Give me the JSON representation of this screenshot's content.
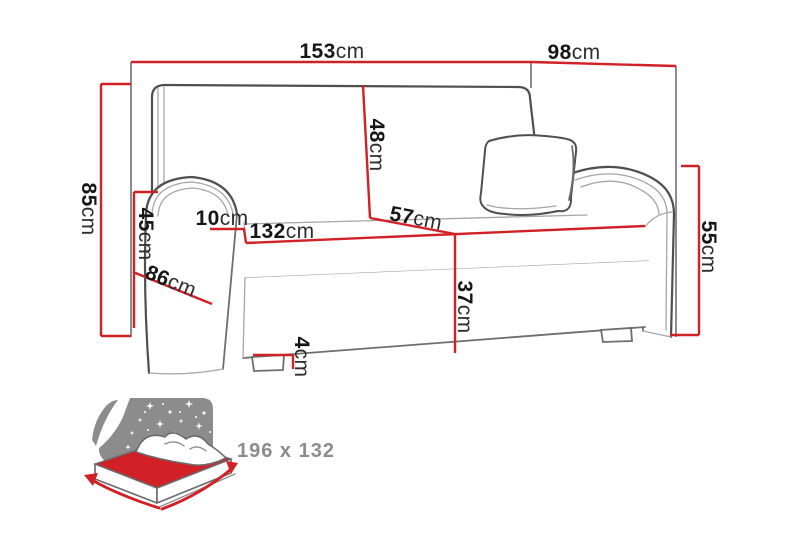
{
  "colors": {
    "red": "#d22027",
    "outline": "#4f4f4f",
    "seam": "#a6a6a6",
    "ext": "#3f3f3f",
    "text": "#161616",
    "icon-gray": "#8c8c8c"
  },
  "dims": {
    "overall_width": {
      "value": "153",
      "unit": "cm"
    },
    "overall_depth": {
      "value": "98",
      "unit": "cm"
    },
    "overall_height": {
      "value": "85",
      "unit": "cm"
    },
    "armrest_height": {
      "value": "45",
      "unit": "cm"
    },
    "armrest_width": {
      "value": "10",
      "unit": "cm"
    },
    "seat_width": {
      "value": "132",
      "unit": "cm"
    },
    "side_depth": {
      "value": "86",
      "unit": "cm"
    },
    "backrest_height": {
      "value": "48",
      "unit": "cm"
    },
    "seat_depth": {
      "value": "57",
      "unit": "cm"
    },
    "seat_height": {
      "value": "37",
      "unit": "cm"
    },
    "right_arm_height": {
      "value": "55",
      "unit": "cm"
    },
    "leg_height": {
      "value": "4",
      "unit": "cm"
    }
  },
  "bed": {
    "size": "196 x 132"
  }
}
